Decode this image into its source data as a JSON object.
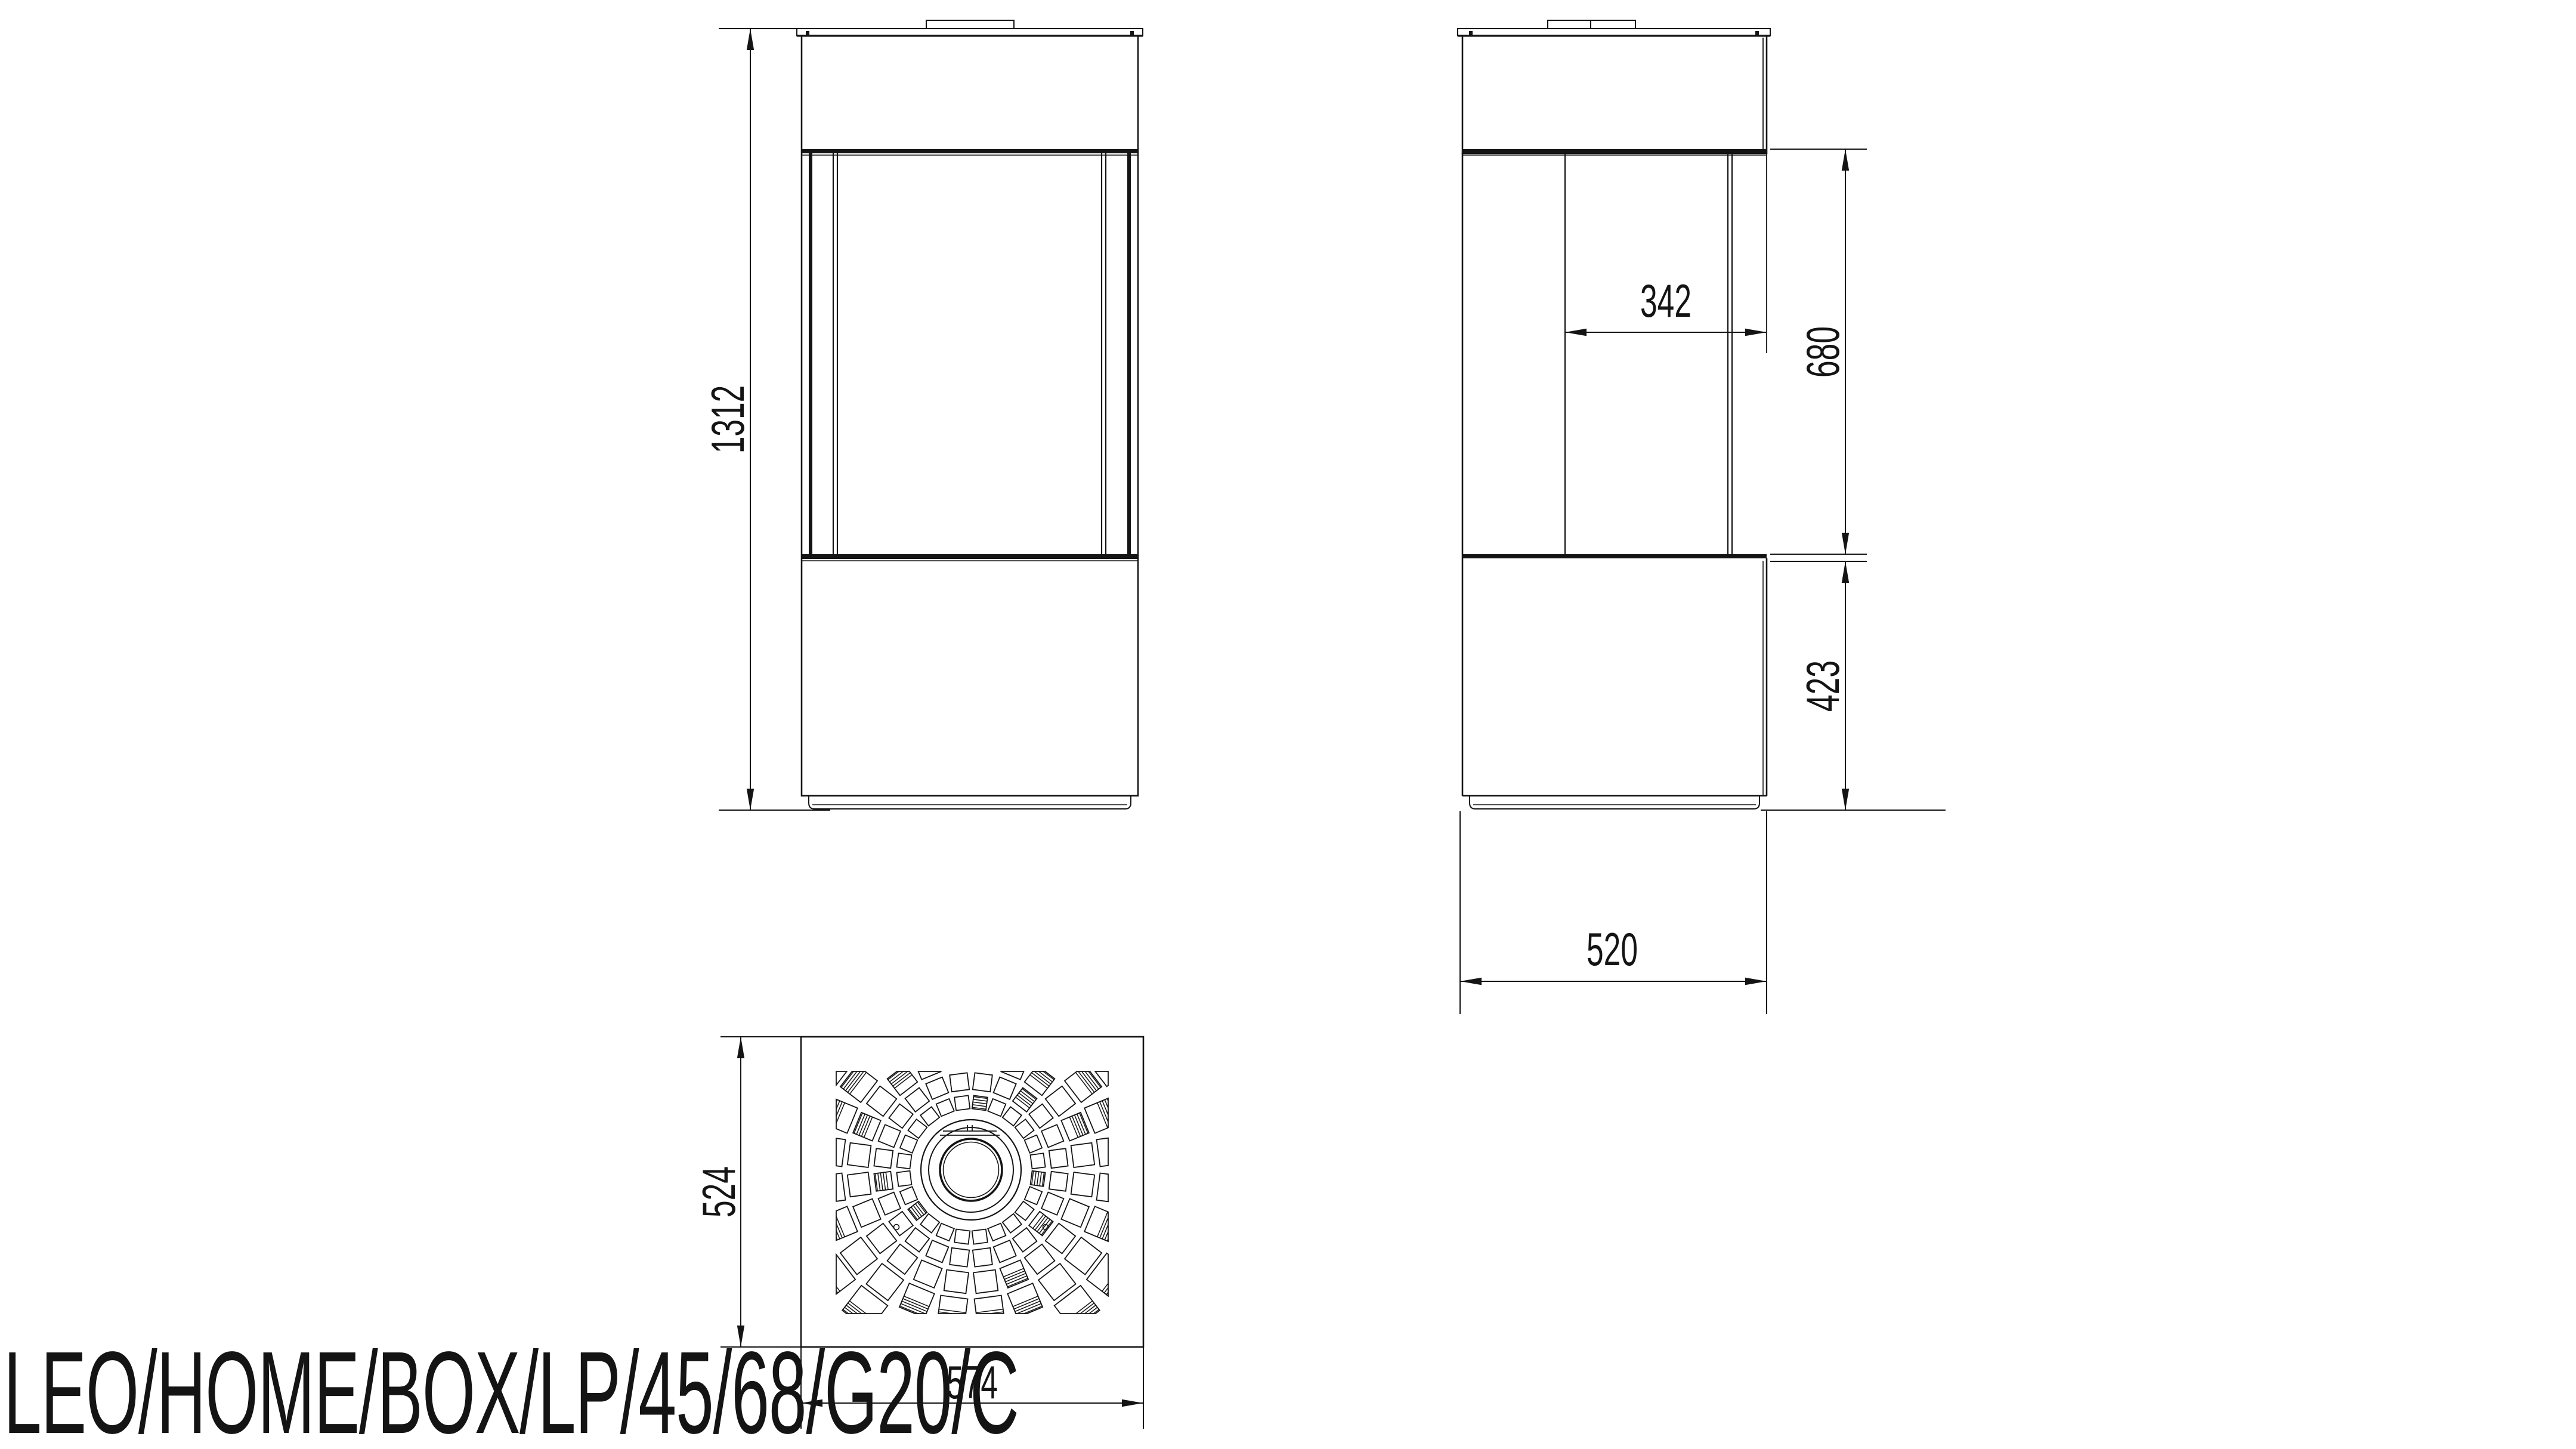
{
  "product_code": "LEO/HOME/BOX/LP/45/68/G20/C",
  "colors": {
    "ink": "#141414",
    "background": "#ffffff"
  },
  "dimensions": {
    "overall_height": "1312",
    "door_depth": "342",
    "firebox_height": "680",
    "base_height": "423",
    "body_depth": "520",
    "top_plate_depth": "524",
    "top_plate_width": "574"
  },
  "views": {
    "front": "front-elevation",
    "side": "side-elevation",
    "top": "top-plan"
  }
}
